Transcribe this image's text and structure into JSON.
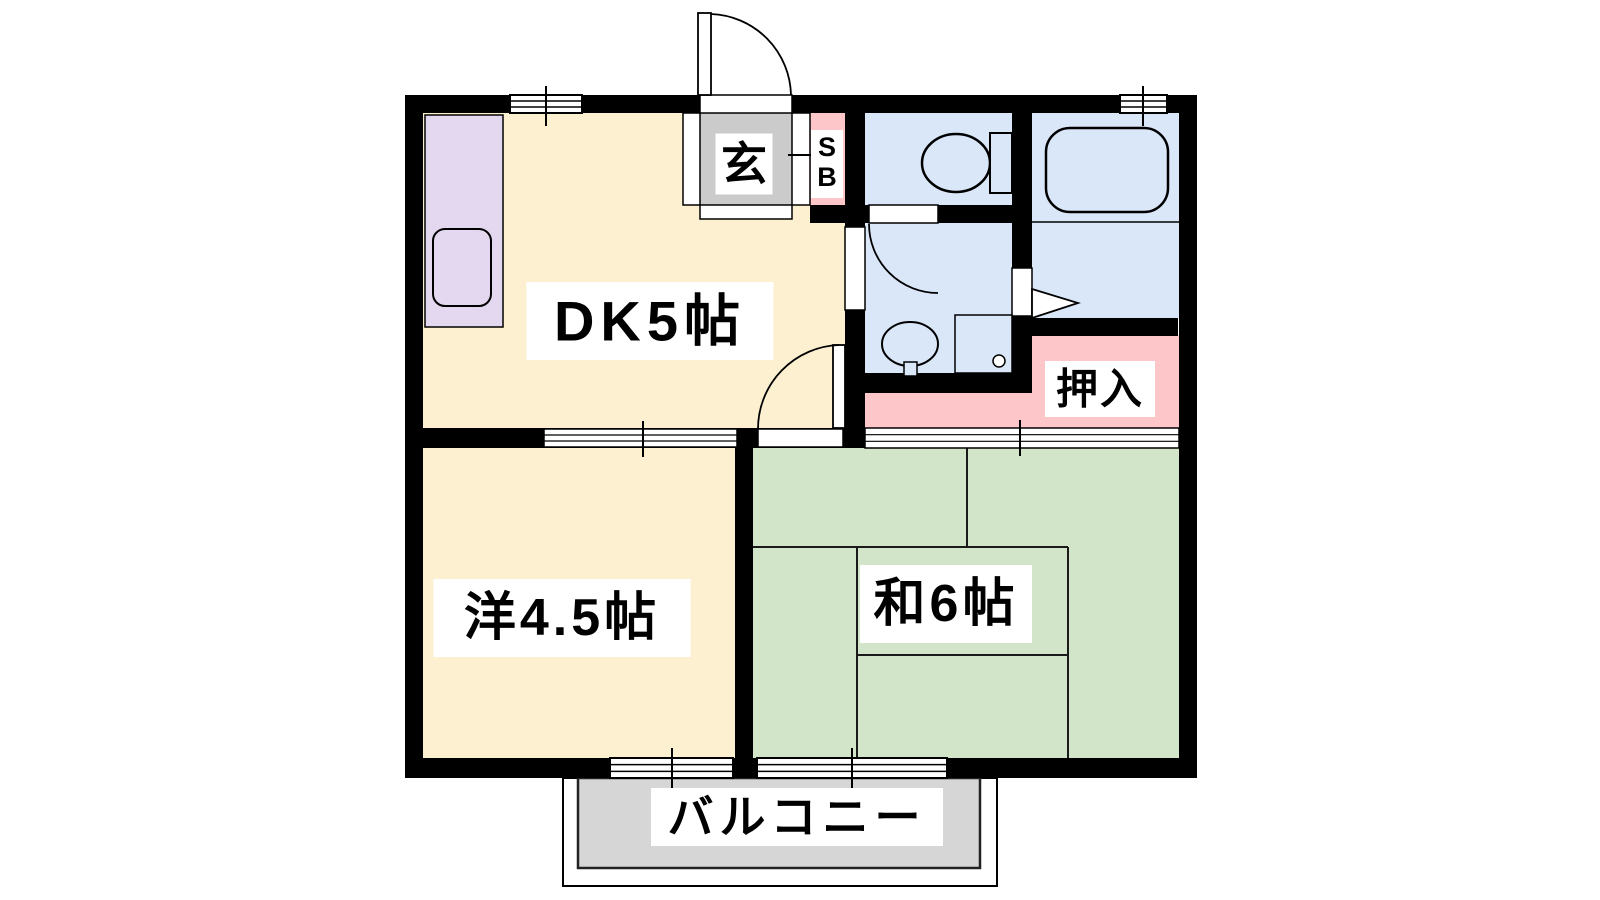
{
  "title": "2DK apartment floor plan",
  "canvas": {
    "w": 1600,
    "h": 900,
    "bg": "#ffffff"
  },
  "colors": {
    "wall": "#000000",
    "cream": "#FDF0D0",
    "green": "#D3E5C9",
    "blue": "#DAE7F8",
    "pink": "#FDC6C9",
    "purple": "#E4D8F0",
    "genkan_gray": "#CBCBCB",
    "balcony_gray": "#D6D6D6",
    "tatami_line": "#1a1a1a",
    "label_bg": "#ffffff"
  },
  "rooms": [
    {
      "name": "room-dk",
      "x": 423,
      "y": 113,
      "w": 422,
      "h": 315,
      "color": "cream"
    },
    {
      "name": "room-western",
      "x": 423,
      "y": 448,
      "w": 312,
      "h": 310,
      "color": "cream"
    },
    {
      "name": "room-japanese",
      "x": 753,
      "y": 447,
      "w": 426,
      "h": 311,
      "color": "green"
    },
    {
      "name": "room-toilet",
      "x": 865,
      "y": 113,
      "w": 147,
      "h": 92,
      "color": "blue"
    },
    {
      "name": "room-washroom",
      "x": 865,
      "y": 222,
      "w": 147,
      "h": 151,
      "color": "blue"
    },
    {
      "name": "room-bath",
      "x": 1032,
      "y": 113,
      "w": 147,
      "h": 205,
      "color": "blue"
    },
    {
      "name": "genkan-floor",
      "x": 700,
      "y": 113,
      "w": 92,
      "h": 92,
      "color": "genkan_gray"
    },
    {
      "name": "shoebox-area",
      "x": 810,
      "y": 113,
      "w": 35,
      "h": 92,
      "color": "pink"
    },
    {
      "name": "closet-upper",
      "x": 1032,
      "y": 335,
      "w": 147,
      "h": 92,
      "color": "pink"
    },
    {
      "name": "closet-lower",
      "x": 865,
      "y": 392,
      "w": 314,
      "h": 36,
      "color": "pink"
    }
  ],
  "balcony": {
    "outer": {
      "x": 563,
      "y": 778,
      "w": 434,
      "h": 108
    },
    "inner": {
      "x": 578,
      "y": 778,
      "w": 402,
      "h": 90
    }
  },
  "walls": [
    [
      405,
      95,
      792,
      18
    ],
    [
      405,
      758,
      792,
      20
    ],
    [
      405,
      95,
      18,
      683
    ],
    [
      1179,
      95,
      18,
      683
    ],
    [
      845,
      113,
      20,
      335
    ],
    [
      810,
      205,
      202,
      18
    ],
    [
      1012,
      113,
      20,
      280
    ],
    [
      845,
      373,
      167,
      20
    ],
    [
      1032,
      318,
      146,
      18
    ],
    [
      423,
      428,
      442,
      20
    ],
    [
      735,
      448,
      18,
      310
    ]
  ],
  "openings": [
    {
      "name": "entrance-opening",
      "x": 700,
      "y": 95,
      "w": 92,
      "h": 18
    },
    {
      "name": "genkan-frame-left",
      "x": 683,
      "y": 113,
      "w": 17,
      "h": 92
    },
    {
      "name": "genkan-frame-right",
      "x": 792,
      "y": 113,
      "w": 18,
      "h": 92
    },
    {
      "name": "genkan-step",
      "x": 700,
      "y": 205,
      "w": 92,
      "h": 14
    },
    {
      "name": "toilet-washroom-opening",
      "x": 869,
      "y": 205,
      "w": 69,
      "h": 18
    },
    {
      "name": "dk-washroom-opening",
      "x": 845,
      "y": 227,
      "w": 20,
      "h": 83
    },
    {
      "name": "bath-door-opening",
      "x": 1012,
      "y": 268,
      "w": 20,
      "h": 48
    },
    {
      "name": "dk-japanese-opening",
      "x": 758,
      "y": 429,
      "w": 85,
      "h": 18
    }
  ],
  "windows": [
    {
      "name": "window-dk-top",
      "x": 510,
      "y": 95,
      "w": 72,
      "h": 18
    },
    {
      "name": "window-bath-top",
      "x": 1120,
      "y": 95,
      "w": 47,
      "h": 18
    },
    {
      "name": "window-western-south",
      "x": 610,
      "y": 758,
      "w": 123,
      "h": 20
    },
    {
      "name": "window-japanese-south",
      "x": 757,
      "y": 758,
      "w": 190,
      "h": 20
    }
  ],
  "sliding_doors": [
    {
      "name": "sliding-door-dk-western",
      "x": 544,
      "y": 429,
      "w": 193,
      "h": 18
    },
    {
      "name": "fusuma-japanese-north",
      "x": 865,
      "y": 428,
      "w": 314,
      "h": 20
    }
  ],
  "ticks": [
    [
      546,
      86,
      546,
      126
    ],
    [
      1143,
      86,
      1143,
      126
    ],
    [
      672,
      748,
      672,
      792
    ],
    [
      852,
      748,
      852,
      792
    ],
    [
      643,
      421,
      643,
      457
    ],
    [
      1020,
      420,
      1020,
      456
    ],
    [
      788,
      155,
      816,
      155
    ]
  ],
  "doors": {
    "entrance_leaf": {
      "x": 698,
      "y": 13,
      "w": 13,
      "h": 82
    },
    "entrance_arc": "M 711 14 A 83 83 0 0 1 791 95",
    "toilet_wash_arc": "M 869 224 A 69 69 0 0 0 938 293",
    "dk_japanese_leaf": {
      "x": 833,
      "y": 345,
      "w": 12,
      "h": 83
    },
    "dk_japanese_arc": "M 839 345 A 84 84 0 0 0 758 429",
    "bath_door_triangle": "M 1032 289 L 1078 303 L 1032 318 Z"
  },
  "fixtures": {
    "kitchen_counter": {
      "x": 425,
      "y": 115,
      "w": 78,
      "h": 212
    },
    "kitchen_sink": {
      "x": 433,
      "y": 229,
      "w": 58,
      "h": 77,
      "r": 12
    },
    "bathtub": {
      "x": 1046,
      "y": 128,
      "w": 122,
      "h": 84,
      "r": 24
    },
    "bath_platform_line": [
      1032,
      222,
      1179,
      222
    ],
    "toilet_bowl": {
      "cx": 956,
      "cy": 163,
      "rx": 34,
      "ry": 29
    },
    "toilet_tank": {
      "x": 990,
      "y": 133,
      "w": 22,
      "h": 60
    },
    "washbasin": {
      "cx": 910,
      "cy": 344,
      "rx": 28,
      "ry": 22
    },
    "washbasin_stem": {
      "x": 904,
      "y": 362,
      "w": 13,
      "h": 14
    },
    "washing_machine": {
      "x": 955,
      "y": 315,
      "w": 57,
      "h": 58
    },
    "washing_machine_drain": {
      "cx": 999,
      "cy": 361,
      "r": 6
    }
  },
  "tatami_lines": [
    [
      753,
      547,
      1068,
      547
    ],
    [
      967,
      447,
      967,
      547
    ],
    [
      1068,
      547,
      1068,
      758
    ],
    [
      857,
      547,
      857,
      758
    ],
    [
      857,
      655,
      1068,
      655
    ]
  ],
  "labels": [
    {
      "id": "label-dk",
      "text": "DK5帖",
      "cx": 650,
      "cy": 321,
      "w": 247,
      "h": 78,
      "font": 56,
      "ls": 6
    },
    {
      "id": "label-western",
      "text": "洋4.5帖",
      "cx": 562,
      "cy": 618,
      "w": 257,
      "h": 78,
      "font": 52,
      "ls": 4
    },
    {
      "id": "label-japanese",
      "text": "和6帖",
      "cx": 946,
      "cy": 604,
      "w": 172,
      "h": 78,
      "font": 52,
      "ls": 4
    },
    {
      "id": "label-genkan",
      "text": "玄",
      "cx": 744,
      "cy": 164,
      "w": 57,
      "h": 61,
      "font": 46,
      "ls": 0
    },
    {
      "id": "label-oshiire",
      "text": "押入",
      "cx": 1100,
      "cy": 389,
      "w": 110,
      "h": 56,
      "font": 42,
      "ls": 2
    },
    {
      "id": "label-balcony",
      "text": "バルコニー",
      "cx": 797,
      "cy": 817,
      "w": 292,
      "h": 58,
      "font": 46,
      "ls": 6
    }
  ],
  "shoebox_label": {
    "id": "label-shoebox",
    "text": "SB",
    "lines": [
      "S",
      "B"
    ],
    "cx": 827,
    "cy": 164,
    "w": 32,
    "h": 68,
    "font": 27
  }
}
